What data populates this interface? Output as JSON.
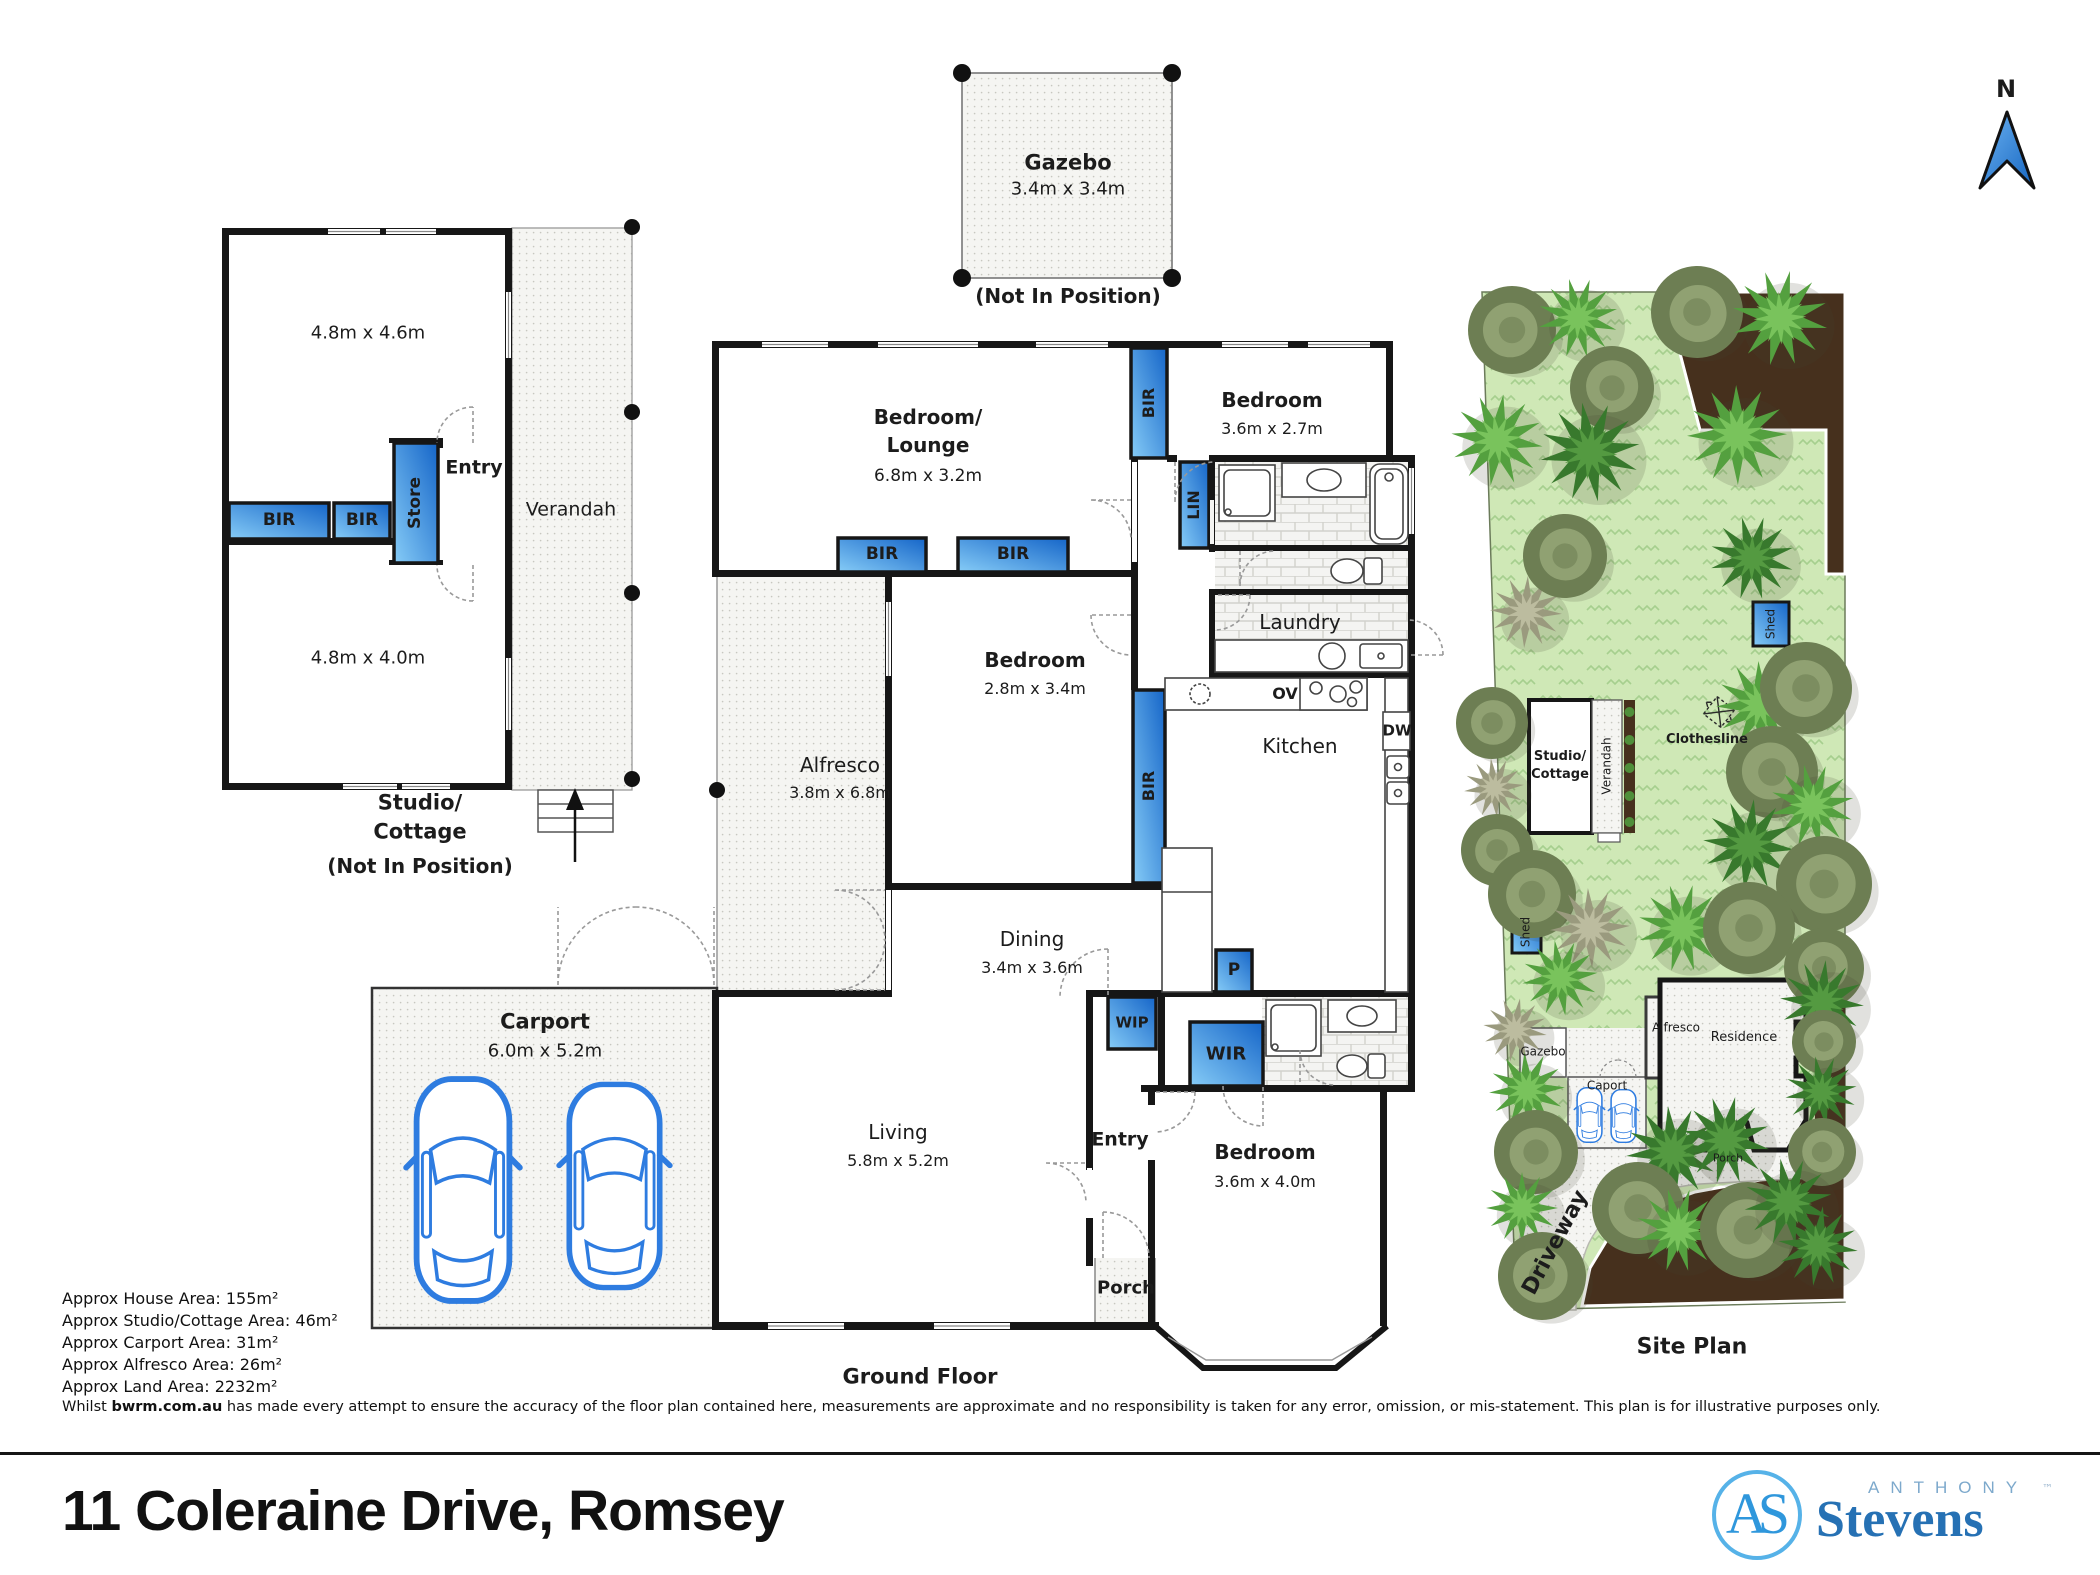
{
  "north_label": "N",
  "gazebo": {
    "title": "Gazebo",
    "dims": "3.4m x 3.4m",
    "note": "(Not In Position)"
  },
  "studio": {
    "room_top_dims": "4.8m x 4.6m",
    "room_bottom_dims": "4.8m x 4.0m",
    "bir": "BIR",
    "store": "Store",
    "entry": "Entry",
    "verandah": "Verandah",
    "title": "Studio/\nCottage",
    "note": "(Not In Position)"
  },
  "house": {
    "bedroom_lounge": {
      "title": "Bedroom/\nLounge",
      "dims": "6.8m x 3.2m"
    },
    "bedroom_top": {
      "title": "Bedroom",
      "dims": "3.6m x 2.7m"
    },
    "bedroom_mid": {
      "title": "Bedroom",
      "dims": "2.8m x 3.4m"
    },
    "bedroom_bottom": {
      "title": "Bedroom",
      "dims": "3.6m x 4.0m"
    },
    "alfresco": {
      "title": "Alfresco",
      "dims": "3.8m x 6.8m"
    },
    "dining": {
      "title": "Dining",
      "dims": "3.4m x 3.6m"
    },
    "living": {
      "title": "Living",
      "dims": "5.8m x 5.2m"
    },
    "carport": {
      "title": "Carport",
      "dims": "6.0m x 5.2m"
    },
    "kitchen": "Kitchen",
    "laundry": "Laundry",
    "entry": "Entry",
    "porch": "Porch",
    "bir": "BIR",
    "lin": "LIN",
    "wip": "WIP",
    "wir": "WIR",
    "pantry": "P",
    "oven": "OV",
    "dishwasher": "DW",
    "floor_label": "Ground Floor"
  },
  "site": {
    "title": "Site Plan",
    "shed": "Shed",
    "studio_cottage": "Studio/\nCottage",
    "verandah": "Verandah",
    "clothesline": "Clothesline",
    "gazebo": "Gazebo",
    "alfresco": "Alfresco",
    "residence": "Residence",
    "carport": "Caport",
    "porch": "Porch",
    "driveway": "Driveway"
  },
  "footer": {
    "areas": [
      "Approx House Area: 155m²",
      "Approx Studio/Cottage Area: 46m²",
      "Approx Carport Area: 31m²",
      "Approx Alfresco Area: 26m²",
      "Approx Land Area: 2232m²"
    ],
    "disclaimer_prefix": "Whilst ",
    "disclaimer_site": "bwrm.com.au",
    "disclaimer_rest": " has made every attempt to ensure the accuracy of the floor plan contained here, measurements are approximate and no responsibility is taken for any error, omission, or mis-statement. This plan is for illustrative purposes only.",
    "address": "11 Coleraine Drive, Romsey"
  },
  "logo": {
    "monogram": "AS",
    "brand_top": "ANTHONY",
    "brand_bottom": "Stevens",
    "tm": "™"
  },
  "colors": {
    "storage_blue": "#2f86d4",
    "wall_black": "#161616",
    "lawn_green": "#cfe8b6",
    "garden_brown": "#46301d",
    "car_blue": "#2e7ce0",
    "logo_blue": "#2671b4"
  }
}
